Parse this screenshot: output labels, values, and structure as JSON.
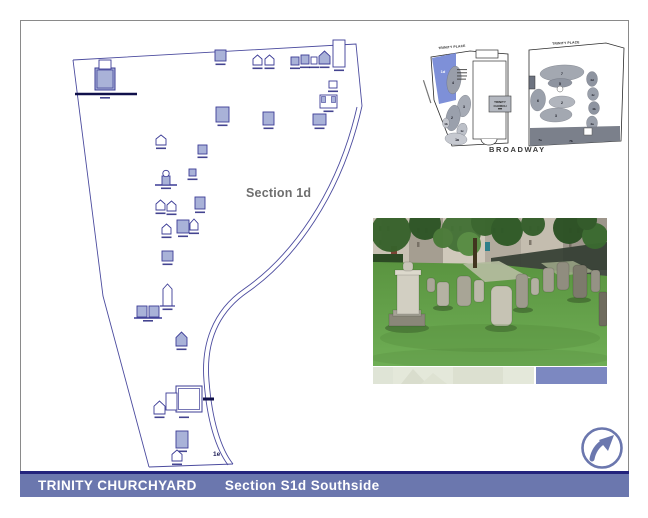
{
  "title_bar": {
    "title": "TRINITY CHURCHYARD",
    "subtitle": "Section S1d Southside",
    "bg": "#6b77ae",
    "rule_color": "#23237c",
    "text_color": "#ffffff"
  },
  "plan": {
    "label": "Section 1d",
    "corner_label": "1e",
    "line_color": "#3c3c96",
    "marker_fill": "#a9b2d8",
    "label_color": "#6e6e6e",
    "markers": [
      {
        "x": 95,
        "y": 60,
        "w": 20,
        "h": 30,
        "type": "cap"
      },
      {
        "x": 215,
        "y": 50,
        "w": 11,
        "h": 11,
        "s": 1
      },
      {
        "x": 253,
        "y": 55,
        "w": 9,
        "h": 10,
        "type": "h"
      },
      {
        "x": 265,
        "y": 55,
        "w": 9,
        "h": 10,
        "type": "h"
      },
      {
        "x": 291,
        "y": 57,
        "w": 8,
        "h": 8,
        "s": 1
      },
      {
        "x": 301,
        "y": 55,
        "w": 8,
        "h": 9,
        "s": 1
      },
      {
        "x": 311,
        "y": 57,
        "w": 6,
        "h": 7
      },
      {
        "x": 319,
        "y": 51,
        "w": 11,
        "h": 13,
        "type": "h",
        "s": 1
      },
      {
        "x": 333,
        "y": 40,
        "w": 12,
        "h": 27
      },
      {
        "x": 329,
        "y": 81,
        "w": 8,
        "h": 7
      },
      {
        "x": 320,
        "y": 95,
        "w": 17,
        "h": 13,
        "type": "u"
      },
      {
        "x": 313,
        "y": 114,
        "w": 13,
        "h": 11,
        "s": 1
      },
      {
        "x": 216,
        "y": 107,
        "w": 13,
        "h": 15,
        "s": 1
      },
      {
        "x": 263,
        "y": 112,
        "w": 11,
        "h": 13,
        "s": 1
      },
      {
        "x": 156,
        "y": 135,
        "w": 10,
        "h": 10,
        "type": "h"
      },
      {
        "x": 198,
        "y": 145,
        "w": 9,
        "h": 9,
        "s": 1
      },
      {
        "x": 189,
        "y": 169,
        "w": 7,
        "h": 7,
        "s": 1
      },
      {
        "x": 158,
        "y": 170,
        "w": 16,
        "h": 15,
        "type": "urn"
      },
      {
        "x": 156,
        "y": 200,
        "w": 9,
        "h": 10,
        "type": "h"
      },
      {
        "x": 167,
        "y": 201,
        "w": 9,
        "h": 10,
        "type": "h"
      },
      {
        "x": 195,
        "y": 197,
        "w": 10,
        "h": 12,
        "s": 1
      },
      {
        "x": 162,
        "y": 224,
        "w": 9,
        "h": 10,
        "type": "h"
      },
      {
        "x": 177,
        "y": 220,
        "w": 12,
        "h": 13,
        "s": 1
      },
      {
        "x": 190,
        "y": 219,
        "w": 8,
        "h": 11,
        "type": "h"
      },
      {
        "x": 162,
        "y": 251,
        "w": 11,
        "h": 10,
        "s": 1
      },
      {
        "x": 163,
        "y": 284,
        "w": 9,
        "h": 22,
        "type": "ob"
      },
      {
        "x": 137,
        "y": 306,
        "w": 22,
        "h": 11,
        "type": "tw"
      },
      {
        "x": 176,
        "y": 332,
        "w": 11,
        "h": 14,
        "type": "h",
        "s": 1
      },
      {
        "x": 166,
        "y": 386,
        "w": 36,
        "h": 28,
        "type": "big"
      },
      {
        "x": 154,
        "y": 401,
        "w": 11,
        "h": 13,
        "type": "h"
      },
      {
        "x": 176,
        "y": 431,
        "w": 12,
        "h": 17,
        "s": 1
      },
      {
        "x": 172,
        "y": 450,
        "w": 10,
        "h": 11,
        "type": "h"
      }
    ]
  },
  "overview_map": {
    "street_label_left": "TRINITY PLACE",
    "street_label_right": "TRINITY PLACE",
    "street_label_bottom": "BROADWAY",
    "church_words": [
      "TRINITY",
      "CHURCH"
    ],
    "highlight_label": "1d",
    "highlight_color": "#7e90d8",
    "south_labels": [
      {
        "t": "1d",
        "x": 443,
        "y": 73,
        "c": "#ffffff",
        "fs": 4
      },
      {
        "t": "4",
        "x": 453,
        "y": 84
      },
      {
        "t": "3",
        "x": 464,
        "y": 108
      },
      {
        "t": "2",
        "x": 452,
        "y": 119
      },
      {
        "t": "1b",
        "x": 446,
        "y": 125,
        "fs": 3
      },
      {
        "t": "1c",
        "x": 462,
        "y": 132,
        "fs": 3
      },
      {
        "t": "1a",
        "x": 457,
        "y": 141
      }
    ],
    "north_labels": [
      {
        "t": "7",
        "x": 562,
        "y": 75
      },
      {
        "t": "5",
        "x": 560,
        "y": 85
      },
      {
        "t": "6",
        "x": 538,
        "y": 102
      },
      {
        "t": "2",
        "x": 562,
        "y": 104
      },
      {
        "t": "3",
        "x": 556,
        "y": 117
      },
      {
        "t": "4d",
        "x": 592,
        "y": 81,
        "fs": 3
      },
      {
        "t": "4c",
        "x": 593,
        "y": 96,
        "fs": 3
      },
      {
        "t": "4b",
        "x": 594,
        "y": 110,
        "fs": 3
      },
      {
        "t": "4a",
        "x": 592,
        "y": 125,
        "fs": 3
      },
      {
        "t": "7a",
        "x": 540,
        "y": 141,
        "fs": 3
      },
      {
        "t": "7b",
        "x": 571,
        "y": 142,
        "fs": 3
      }
    ]
  }
}
